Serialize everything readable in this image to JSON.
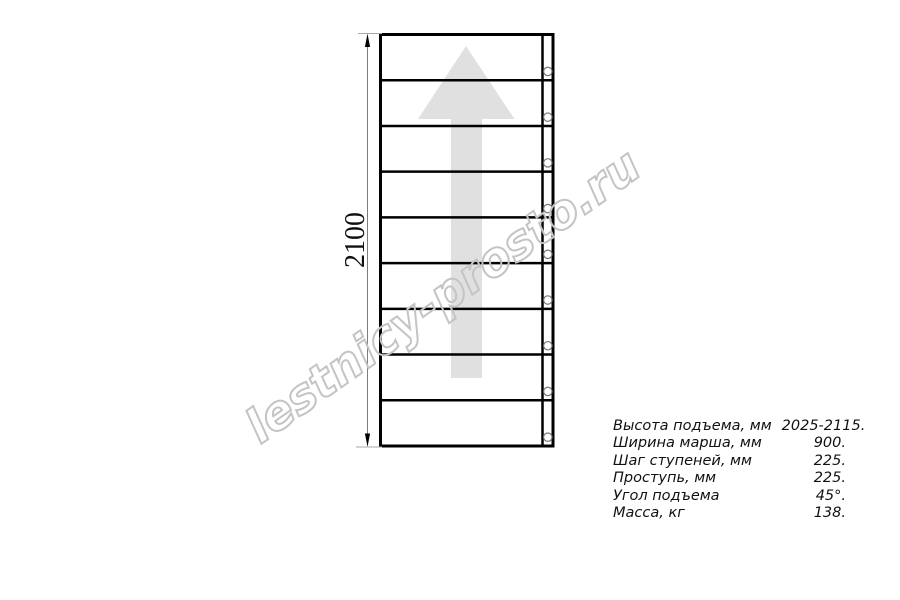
{
  "watermark": {
    "text": "lestnicy-prosto.ru"
  },
  "diagram": {
    "type": "staircase-plan",
    "dimension_label": "2100",
    "step_rows": 9,
    "bolt_circles": 9,
    "direction_arrow": "up",
    "colors": {
      "line": "#000000",
      "arrow_fill": "#e0e0e0",
      "watermark_stroke": "#c4c4c4",
      "dimension_line": "#7d7d7d",
      "extension_line": "#a8a8a8",
      "circle_stroke": "#777777"
    }
  },
  "specs": {
    "rows": [
      {
        "label": "Высота подъема, мм",
        "value": "2025-2115."
      },
      {
        "label": "Ширина марша, мм",
        "value": "900."
      },
      {
        "label": "Шаг ступеней, мм",
        "value": "225."
      },
      {
        "label": "Проступь, мм",
        "value": "225."
      },
      {
        "label": "Угол подъема",
        "value": "45°."
      },
      {
        "label": "Масса, кг",
        "value": "138."
      }
    ]
  }
}
